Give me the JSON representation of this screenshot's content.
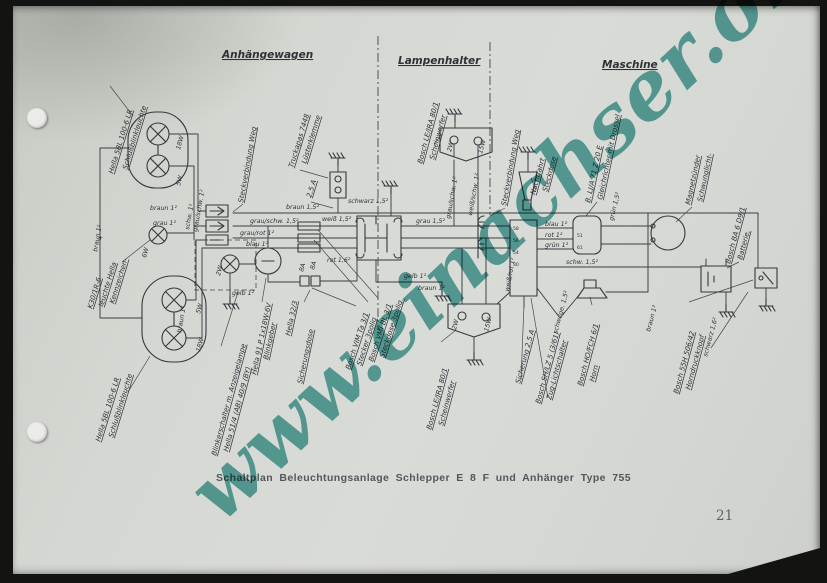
{
  "page": {
    "caption": "Schaltplan Beleuchtungsanlage Schlepper E 8 F und Anhänger Type 755",
    "page_number": "21",
    "watermark": "www.einachser.org",
    "watermark_color": "#3e9d97",
    "paper_color": "#d5d8d2",
    "ink_color": "#3b3e43"
  },
  "diagram": {
    "sections": {
      "left": "Anhängewagen",
      "mid": "Lampenhalter",
      "right": "Maschine"
    },
    "labels": {
      "schlussblink_top_1": "Schlußblinkleuchte",
      "schlussblink_top_2": "Hella 5BL 100-6 LR",
      "kennzeichen_star": "+",
      "kennzeichen_1": "Kennzeichen-",
      "kennzeichen_2": "leuchte Hella",
      "kennzeichen_3": "K30/1R-6",
      "schlussblink_bot_1": "Schlußblinkleuchte",
      "schlussblink_bot_2": "Hella 5BL 100-6 LR",
      "steckverbindung_links": "Steckverbindung Weg",
      "luesterklemme_1": "Lüsterklemme",
      "luesterklemme_2": "Truckapas 7448",
      "sicherung_25a_links": "2,5 A",
      "blinkerschalter_1": "Blinkerschalter m. Anzeigelampe",
      "blinkerschalter_2": "Hella 51/4 (AB) 40/9 (BY)",
      "blinkgeber_1": "Blinkgeber",
      "blinkgeber_2": "Hella 91 P 1x18W-6V",
      "sicherungsdose_1": "Sicherungsdose",
      "sicherungsdose_2": "Hella 32/3",
      "fuse_8a_1": "8A",
      "fuse_8a_2": "8A",
      "steckdose3_1": "Steckdose 3polig.",
      "steckdose3_2": "Bosch VMI BL 3/1",
      "stecker3_1": "Stecker 3polig",
      "stecker3_2": "Bosch VIM Ta 3/1",
      "scheinwerfer_l_1": "Scheinwerfer",
      "scheinwerfer_l_2": "Bosch LE/JRA 80/1",
      "scheinwerfer_r_1": "Scheinwerfer",
      "scheinwerfer_r_2": "Bosch LE/JRA 80/1",
      "steckverbindung_rechts": "Steckverbindung Weg",
      "steckdose_nacht_1": "Steckdose",
      "steckdose_nacht_2": "Nachtfahrt",
      "gleichrichter_1": "Gleichrichter mit Drossel",
      "gleichrichter_2": "B. LJ/A 71 Z 20 E",
      "schwunglicht_1": "Schwunglicht-",
      "schwunglicht_2": "Magnetzünder",
      "batterie_1": "Batterie,",
      "batterie_2": "Bosch BA 6 D9/1",
      "horndruckknopf_1": "Horndruckknopf",
      "horndruckknopf_2": "Bosch 55H 506/42",
      "horn_1": "Horn",
      "horn_2": "Bosch HO/FCH 6/1",
      "zuglichtschalter_1": "Zug-Lichtschalter",
      "zuglichtschalter_2": "Bosch SH/LZ 5 (3/61)",
      "sicherung_25a_rechts": "Sicherung 2,5 A"
    },
    "wires": {
      "braun1_a": "braun 1²",
      "grau1": "grau 1²",
      "braun15_bus": "braun 1,5²",
      "grauschw15": "grau/schw. 1,5²",
      "graurot1": "grau/rot 1²",
      "blau1_bus": "blau 1²",
      "weiss15": "weiß 1,5²",
      "schwarz15": "schwarz 1,5²",
      "rot16": "rot 1,6²",
      "gelb1_a": "gelb 1²",
      "gelb1_b": "gelb 1²",
      "braun1_b": "braun 1²",
      "grau15": "grau 1,5²",
      "weissschw1": "weiß/schw. 1²",
      "grauschw1_a": "grau/schw. 1²",
      "weissrot1": "weiß/rot 1²",
      "blau1_c": "blau 1²",
      "rot1": "rot 1²",
      "gruen1": "grün 1²",
      "schw15": "schw. 1,5²",
      "gruen15": "grün 1,5²",
      "schwge15": "schw./ge. 1,5²",
      "braun1_c": "braun 1²",
      "schwarz16": "schwarz 1,6²",
      "braun1_d": "braun 1²",
      "schw1_lamp": "schw. 1²",
      "grauschw1_b": "grau/schw. 1²",
      "braun1_e": "braun 1²"
    },
    "bulbs": {
      "w18_a": "18W",
      "w5_a": "5W",
      "w6": "6W",
      "w2_ind": "2W",
      "w5_b": "5W",
      "w18_b": "18W",
      "w2_hl_l": "2W",
      "w15_hl_l": "15W",
      "w2_hl_r": "2W",
      "w15_hl_r": "15W"
    },
    "pins": {
      "p58": "58",
      "p56": "56",
      "p54": "54",
      "p30": "30",
      "p51": "51",
      "p61": "61"
    }
  }
}
